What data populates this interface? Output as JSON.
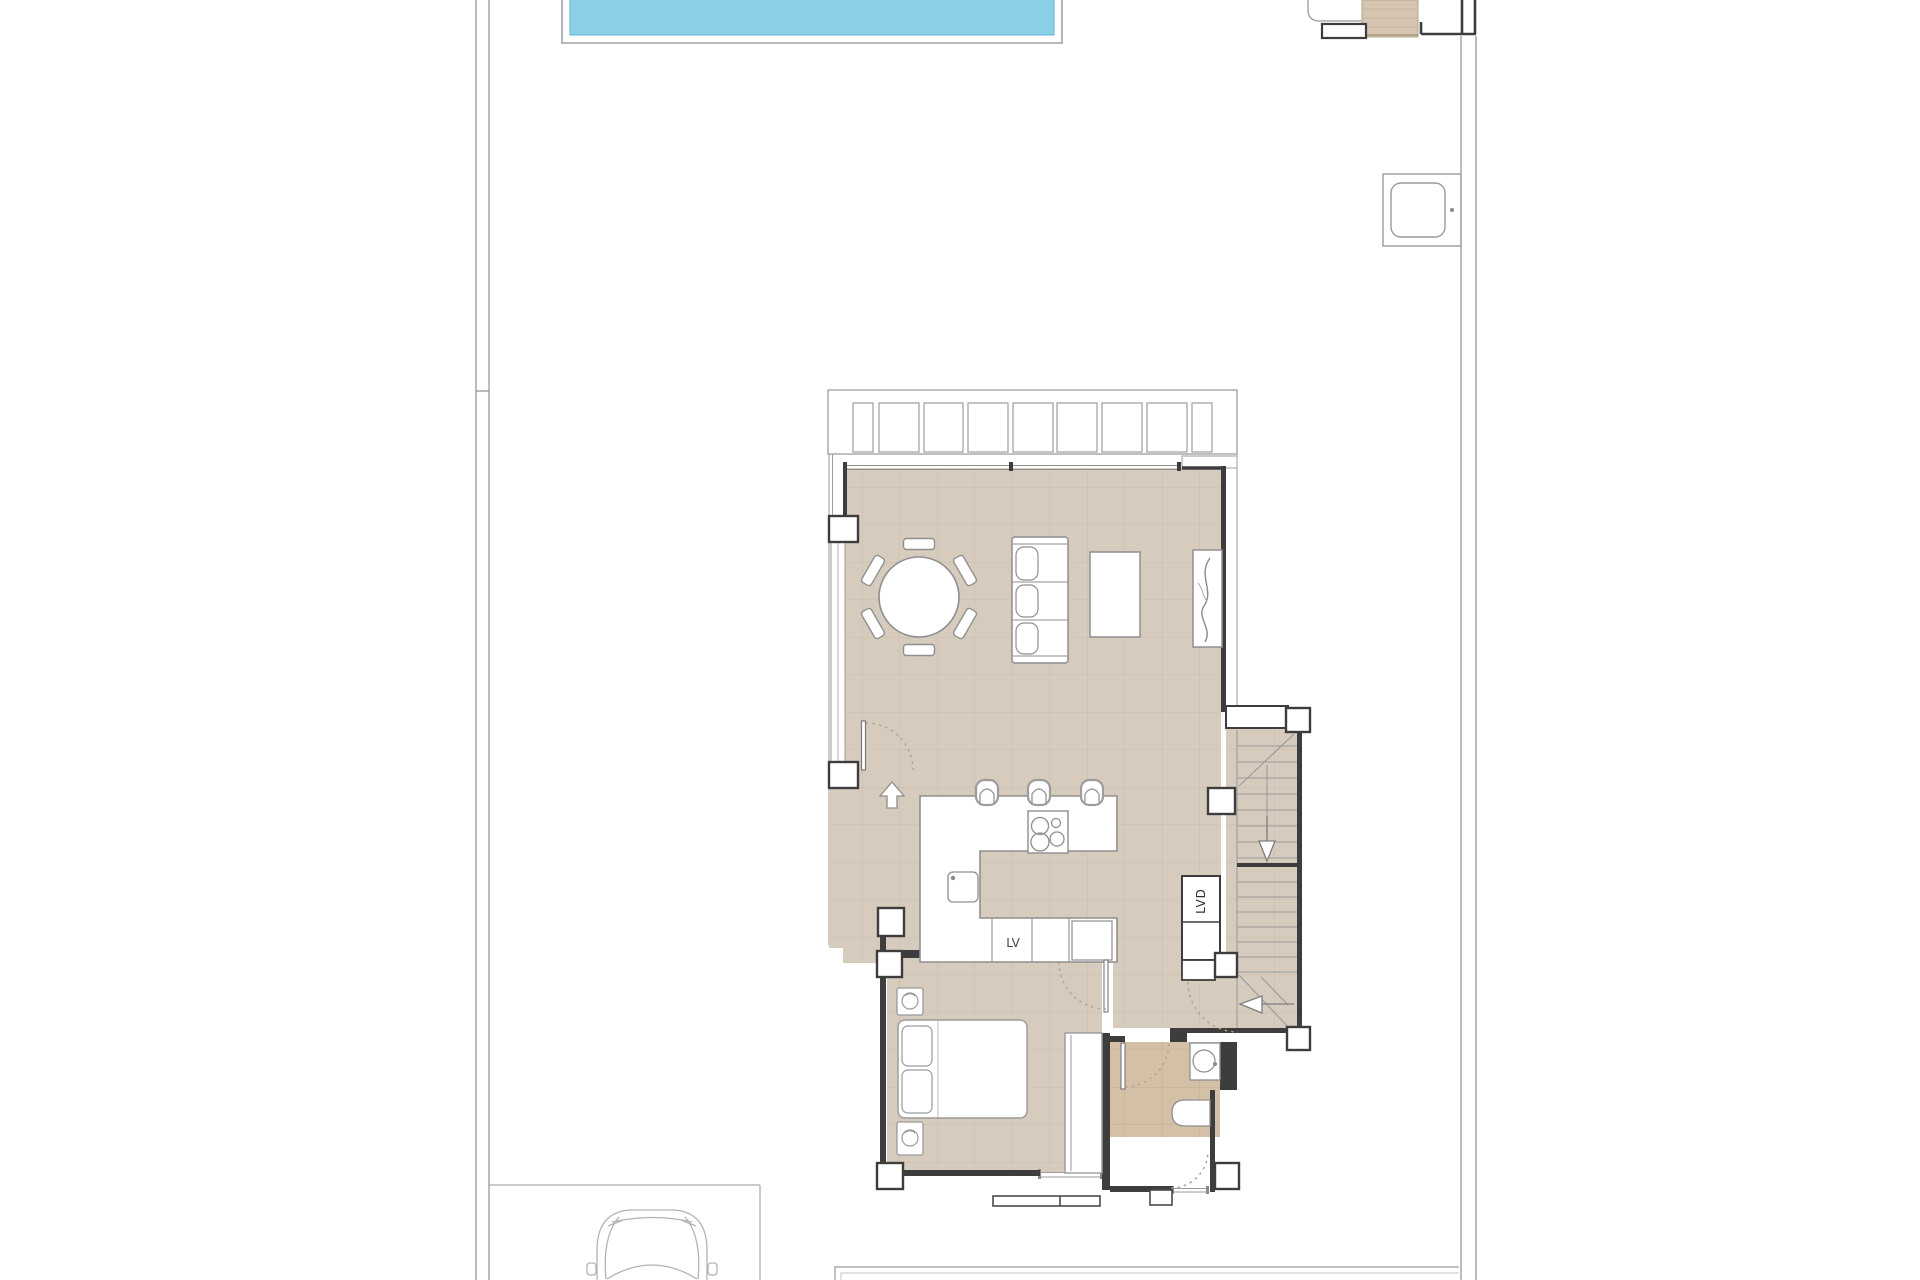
{
  "labels": {
    "dishwasher": "LV",
    "laundry_closet": "LVD"
  },
  "colors": {
    "floor_tile": "#d7cbbd",
    "floor_grid": "#c9bcab",
    "bathroom_tile": "#d3c0a6",
    "bathroom_grid": "#c3ae8f",
    "pool_water": "#8bd0e7",
    "pool_edge": "#66b7d6",
    "wall": "#3d3d3d",
    "entry_steps": "#d6c6b1",
    "line_grey": "#9a9a9a",
    "furniture_line": "#8f8f8f"
  },
  "elements": {
    "site": [
      "plot-boundary-left",
      "plot-boundary-right",
      "swimming-pool",
      "entry-gate-steps",
      "outdoor-shower-tray",
      "parking-area",
      "car",
      "neighbor-building-outline"
    ],
    "house": [
      "pergola-slats",
      "terrace",
      "living-dining-room",
      "kitchen",
      "stairs-upper-flight",
      "stairs-lower-flight",
      "laundry-closet",
      "hallway",
      "bedroom",
      "bathroom"
    ],
    "furniture": [
      "dining-table",
      "dining-chairs",
      "sofa",
      "coffee-table",
      "tv-console",
      "kitchen-island",
      "hob",
      "bar-stools",
      "kitchen-sink",
      "oven",
      "bed",
      "nightstands",
      "wardrobe",
      "bathroom-sink",
      "bathtub"
    ]
  }
}
